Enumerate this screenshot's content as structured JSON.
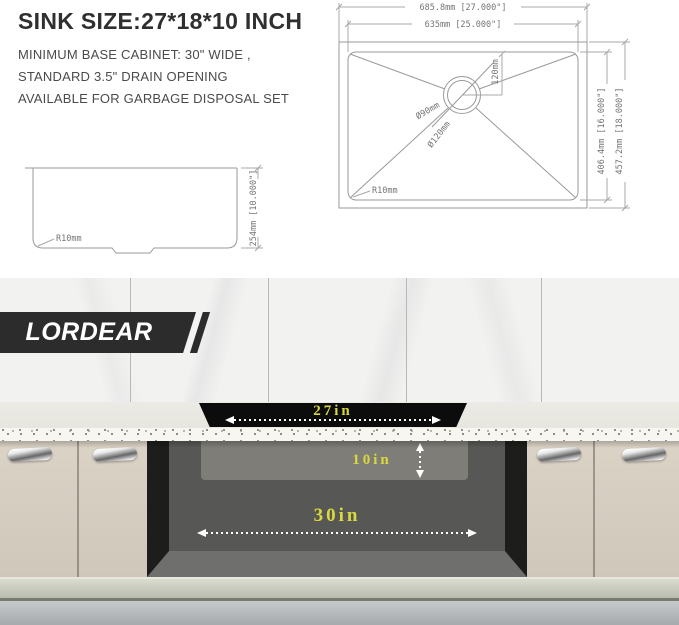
{
  "header": {
    "title": "SINK SIZE:27*18*10 INCH",
    "description_lines": [
      "MINIMUM BASE CABINET: 30\" WIDE ,",
      "STANDARD 3.5\" DRAIN OPENING",
      "AVAILABLE FOR GARBAGE DISPOSAL SET"
    ]
  },
  "blueprint": {
    "top_view": {
      "overall_width": "685.8mm [27.000\"]",
      "basin_width": "635mm [25.000\"]",
      "basin_front_to_back": "406.4mm [16.000\"]",
      "overall_front_to_back": "457.2mm [18.000\"]",
      "drain_offset": "120mm",
      "drain_inner_diameter": "Ø90mm",
      "drain_outer_diameter": "Ø120mm",
      "corner_radius": "R10mm"
    },
    "side_view": {
      "corner_radius": "R10mm",
      "depth": "254mm [10.000\"]"
    }
  },
  "kitchen": {
    "brand": "LORDEAR",
    "sink_width_label": "27in",
    "sink_depth_label": "10in",
    "cabinet_width_label": "30in",
    "colors": {
      "label_yellow": "#d9d93f",
      "banner_background": "#2c2c2c",
      "cabinet_door": "#d9d1c4",
      "counter_top": "#eae9e2"
    }
  }
}
